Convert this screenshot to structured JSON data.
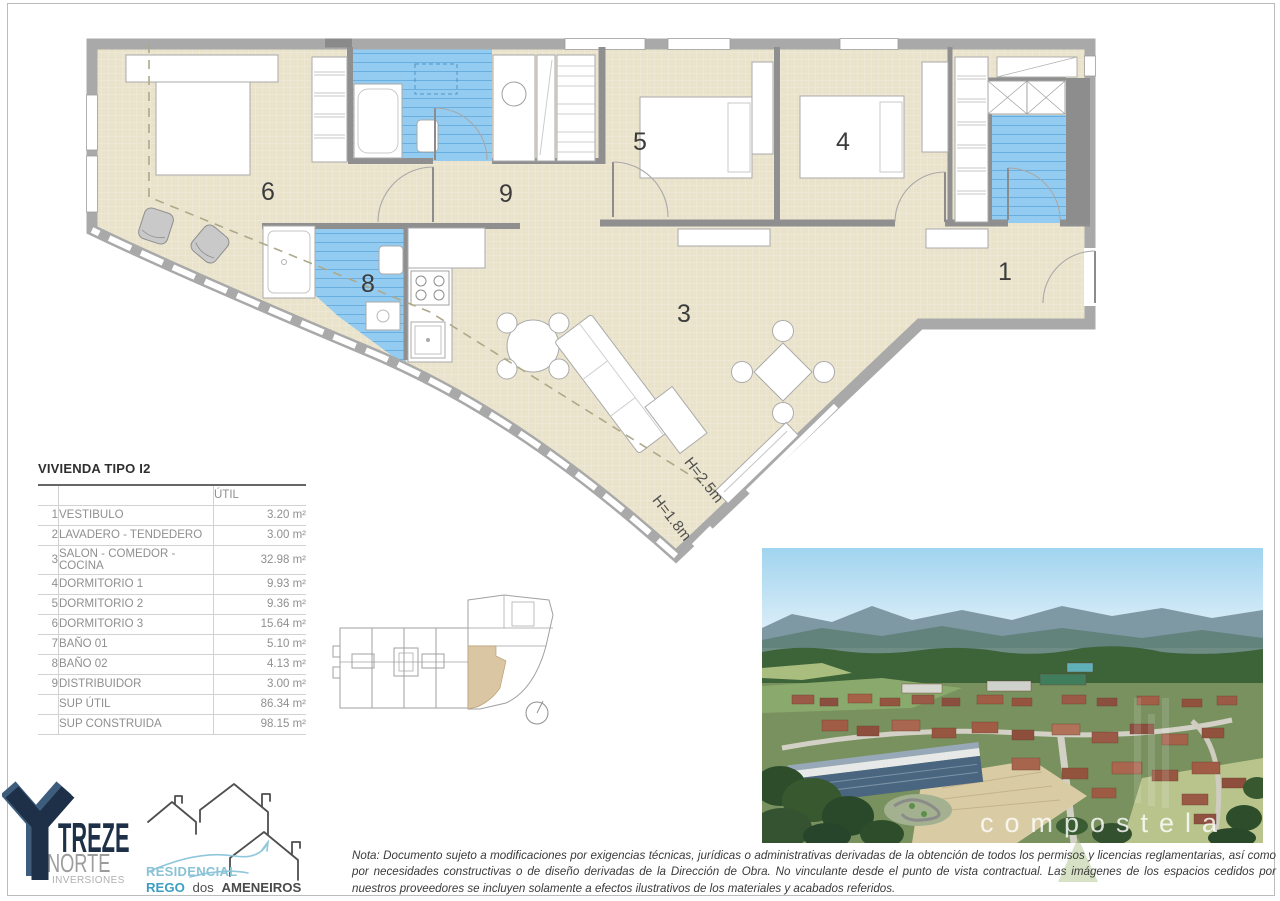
{
  "page": {
    "colors": {
      "floor_beige": "#eae3cc",
      "tile_blue": "#93ccf0",
      "wall_gray": "#a9a9a9",
      "treze_navy": "#1d3047",
      "residencial_light_blue": "#8ac2d6",
      "residencial_blue": "#3d9ec0",
      "key_plan_highlight": "#dbc6a3"
    }
  },
  "floor_plan": {
    "labels": {
      "room1": "1",
      "room3": "3",
      "room4": "4",
      "room5": "5",
      "room6": "6",
      "room8": "8",
      "room9": "9",
      "h_upper": "H=2.5m",
      "h_lower": "H=1.8m"
    }
  },
  "area_table": {
    "title": "VIVIENDA TIPO I2",
    "col_util": "ÚTIL",
    "rows": [
      {
        "num": "1",
        "name": "VESTIBULO",
        "value": "3.20 m²"
      },
      {
        "num": "2",
        "name": "LAVADERO - TENDEDERO",
        "value": "3.00 m²"
      },
      {
        "num": "3",
        "name": "SALON - COMEDOR - COCINA",
        "value": "32.98 m²"
      },
      {
        "num": "4",
        "name": "DORMITORIO 1",
        "value": "9.93 m²"
      },
      {
        "num": "5",
        "name": "DORMITORIO 2",
        "value": "9.36 m²"
      },
      {
        "num": "6",
        "name": "DORMITORIO 3",
        "value": "15.64 m²"
      },
      {
        "num": "7",
        "name": "BAÑO 01",
        "value": "5.10 m²"
      },
      {
        "num": "8",
        "name": "BAÑO 02",
        "value": "4.13 m²"
      },
      {
        "num": "9",
        "name": "DISTRIBUIDOR",
        "value": "3.00 m²"
      }
    ],
    "totals": [
      {
        "name": "SUP ÚTIL",
        "value": "86.34 m²"
      },
      {
        "name": "SUP CONSTRUIDA",
        "value": "98.15 m²"
      }
    ]
  },
  "site_photo": {
    "watermark": "compostela"
  },
  "logos": {
    "treze": {
      "brand": "TREZE",
      "line2": "NORTE",
      "line3": "INVERSIONES"
    },
    "residencial": {
      "line1": "RESIDENCIAL",
      "rego": "REGO",
      "dos": "dos",
      "ameneiros": "AMENEIROS"
    }
  },
  "note": {
    "text": "Nota: Documento sujeto a modificaciones por exigencias técnicas, jurídicas o administrativas derivadas de la obtención de todos los permisos y licencias reglamentarias, así como por necesidades constructivas o de diseño derivadas de la Dirección de Obra. No vinculante desde el punto de vista contractual. Las imágenes de los espacios cedidos por nuestros proveedores se incluyen solamente a efectos ilustrativos de los materiales y acabados referidos."
  }
}
